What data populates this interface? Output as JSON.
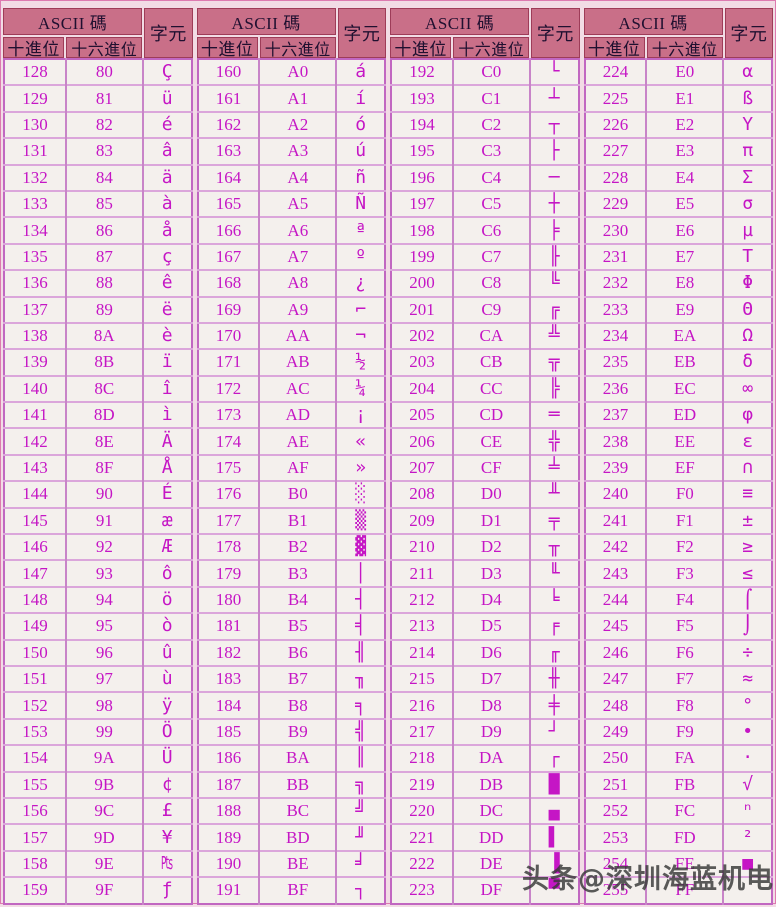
{
  "header": {
    "ascii_label": "ASCII 碼",
    "dec_label": "十進位",
    "hex_label": "十六進位",
    "char_label": "字元"
  },
  "watermark": "头条@深圳海蓝机电",
  "colors": {
    "page_bg": "#f2dce5",
    "header_bg": "#c96f88",
    "header_border": "#9e3c58",
    "header_text": "#201030",
    "table_border": "#c167c1",
    "row_line": "#dba6db",
    "data_text": "#c516c5",
    "cell_bg": "#f4f0ed",
    "watermark_text": "#383838"
  },
  "groups": [
    {
      "rows": [
        [
          "128",
          "80",
          "Ç"
        ],
        [
          "129",
          "81",
          "ü"
        ],
        [
          "130",
          "82",
          "é"
        ],
        [
          "131",
          "83",
          "â"
        ],
        [
          "132",
          "84",
          "ä"
        ],
        [
          "133",
          "85",
          "à"
        ],
        [
          "134",
          "86",
          "å"
        ],
        [
          "135",
          "87",
          "ç"
        ],
        [
          "136",
          "88",
          "ê"
        ],
        [
          "137",
          "89",
          "ë"
        ],
        [
          "138",
          "8A",
          "è"
        ],
        [
          "139",
          "8B",
          "ï"
        ],
        [
          "140",
          "8C",
          "î"
        ],
        [
          "141",
          "8D",
          "ì"
        ],
        [
          "142",
          "8E",
          "Ä"
        ],
        [
          "143",
          "8F",
          "Å"
        ],
        [
          "144",
          "90",
          "É"
        ],
        [
          "145",
          "91",
          "æ"
        ],
        [
          "146",
          "92",
          "Æ"
        ],
        [
          "147",
          "93",
          "ô"
        ],
        [
          "148",
          "94",
          "ö"
        ],
        [
          "149",
          "95",
          "ò"
        ],
        [
          "150",
          "96",
          "û"
        ],
        [
          "151",
          "97",
          "ù"
        ],
        [
          "152",
          "98",
          "ÿ"
        ],
        [
          "153",
          "99",
          "Ö"
        ],
        [
          "154",
          "9A",
          "Ü"
        ],
        [
          "155",
          "9B",
          "¢"
        ],
        [
          "156",
          "9C",
          "£"
        ],
        [
          "157",
          "9D",
          "¥"
        ],
        [
          "158",
          "9E",
          "₧"
        ],
        [
          "159",
          "9F",
          "ƒ"
        ]
      ]
    },
    {
      "rows": [
        [
          "160",
          "A0",
          "á"
        ],
        [
          "161",
          "A1",
          "í"
        ],
        [
          "162",
          "A2",
          "ó"
        ],
        [
          "163",
          "A3",
          "ú"
        ],
        [
          "164",
          "A4",
          "ñ"
        ],
        [
          "165",
          "A5",
          "Ñ"
        ],
        [
          "166",
          "A6",
          "ª"
        ],
        [
          "167",
          "A7",
          "º"
        ],
        [
          "168",
          "A8",
          "¿"
        ],
        [
          "169",
          "A9",
          "⌐"
        ],
        [
          "170",
          "AA",
          "¬"
        ],
        [
          "171",
          "AB",
          "½"
        ],
        [
          "172",
          "AC",
          "¼"
        ],
        [
          "173",
          "AD",
          "¡"
        ],
        [
          "174",
          "AE",
          "«"
        ],
        [
          "175",
          "AF",
          "»"
        ],
        [
          "176",
          "B0",
          "░"
        ],
        [
          "177",
          "B1",
          "▒"
        ],
        [
          "178",
          "B2",
          "▓"
        ],
        [
          "179",
          "B3",
          "│"
        ],
        [
          "180",
          "B4",
          "┤"
        ],
        [
          "181",
          "B5",
          "╡"
        ],
        [
          "182",
          "B6",
          "╢"
        ],
        [
          "183",
          "B7",
          "╖"
        ],
        [
          "184",
          "B8",
          "╕"
        ],
        [
          "185",
          "B9",
          "╣"
        ],
        [
          "186",
          "BA",
          "║"
        ],
        [
          "187",
          "BB",
          "╗"
        ],
        [
          "188",
          "BC",
          "╝"
        ],
        [
          "189",
          "BD",
          "╜"
        ],
        [
          "190",
          "BE",
          "╛"
        ],
        [
          "191",
          "BF",
          "┐"
        ]
      ]
    },
    {
      "rows": [
        [
          "192",
          "C0",
          "└"
        ],
        [
          "193",
          "C1",
          "┴"
        ],
        [
          "194",
          "C2",
          "┬"
        ],
        [
          "195",
          "C3",
          "├"
        ],
        [
          "196",
          "C4",
          "─"
        ],
        [
          "197",
          "C5",
          "┼"
        ],
        [
          "198",
          "C6",
          "╞"
        ],
        [
          "199",
          "C7",
          "╟"
        ],
        [
          "200",
          "C8",
          "╚"
        ],
        [
          "201",
          "C9",
          "╔"
        ],
        [
          "202",
          "CA",
          "╩"
        ],
        [
          "203",
          "CB",
          "╦"
        ],
        [
          "204",
          "CC",
          "╠"
        ],
        [
          "205",
          "CD",
          "═"
        ],
        [
          "206",
          "CE",
          "╬"
        ],
        [
          "207",
          "CF",
          "╧"
        ],
        [
          "208",
          "D0",
          "╨"
        ],
        [
          "209",
          "D1",
          "╤"
        ],
        [
          "210",
          "D2",
          "╥"
        ],
        [
          "211",
          "D3",
          "╙"
        ],
        [
          "212",
          "D4",
          "╘"
        ],
        [
          "213",
          "D5",
          "╒"
        ],
        [
          "214",
          "D6",
          "╓"
        ],
        [
          "215",
          "D7",
          "╫"
        ],
        [
          "216",
          "D8",
          "╪"
        ],
        [
          "217",
          "D9",
          "┘"
        ],
        [
          "218",
          "DA",
          "┌"
        ],
        [
          "219",
          "DB",
          "█"
        ],
        [
          "220",
          "DC",
          "▄"
        ],
        [
          "221",
          "DD",
          "▌"
        ],
        [
          "222",
          "DE",
          "▐"
        ],
        [
          "223",
          "DF",
          "▀"
        ]
      ]
    },
    {
      "rows": [
        [
          "224",
          "E0",
          "α"
        ],
        [
          "225",
          "E1",
          "ß"
        ],
        [
          "226",
          "E2",
          "Υ"
        ],
        [
          "227",
          "E3",
          "π"
        ],
        [
          "228",
          "E4",
          "Σ"
        ],
        [
          "229",
          "E5",
          "σ"
        ],
        [
          "230",
          "E6",
          "µ"
        ],
        [
          "231",
          "E7",
          "Τ"
        ],
        [
          "232",
          "E8",
          "Φ"
        ],
        [
          "233",
          "E9",
          "Θ"
        ],
        [
          "234",
          "EA",
          "Ω"
        ],
        [
          "235",
          "EB",
          "δ"
        ],
        [
          "236",
          "EC",
          "∞"
        ],
        [
          "237",
          "ED",
          "φ"
        ],
        [
          "238",
          "EE",
          "ε"
        ],
        [
          "239",
          "EF",
          "∩"
        ],
        [
          "240",
          "F0",
          "≡"
        ],
        [
          "241",
          "F1",
          "±"
        ],
        [
          "242",
          "F2",
          "≥"
        ],
        [
          "243",
          "F3",
          "≤"
        ],
        [
          "244",
          "F4",
          "⌠"
        ],
        [
          "245",
          "F5",
          "⌡"
        ],
        [
          "246",
          "F6",
          "÷"
        ],
        [
          "247",
          "F7",
          "≈"
        ],
        [
          "248",
          "F8",
          "°"
        ],
        [
          "249",
          "F9",
          "•"
        ],
        [
          "250",
          "FA",
          "·"
        ],
        [
          "251",
          "FB",
          "√"
        ],
        [
          "252",
          "FC",
          "ⁿ"
        ],
        [
          "253",
          "FD",
          "²"
        ],
        [
          "254",
          "FE",
          "■"
        ],
        [
          "255",
          "FF",
          ""
        ]
      ]
    }
  ]
}
